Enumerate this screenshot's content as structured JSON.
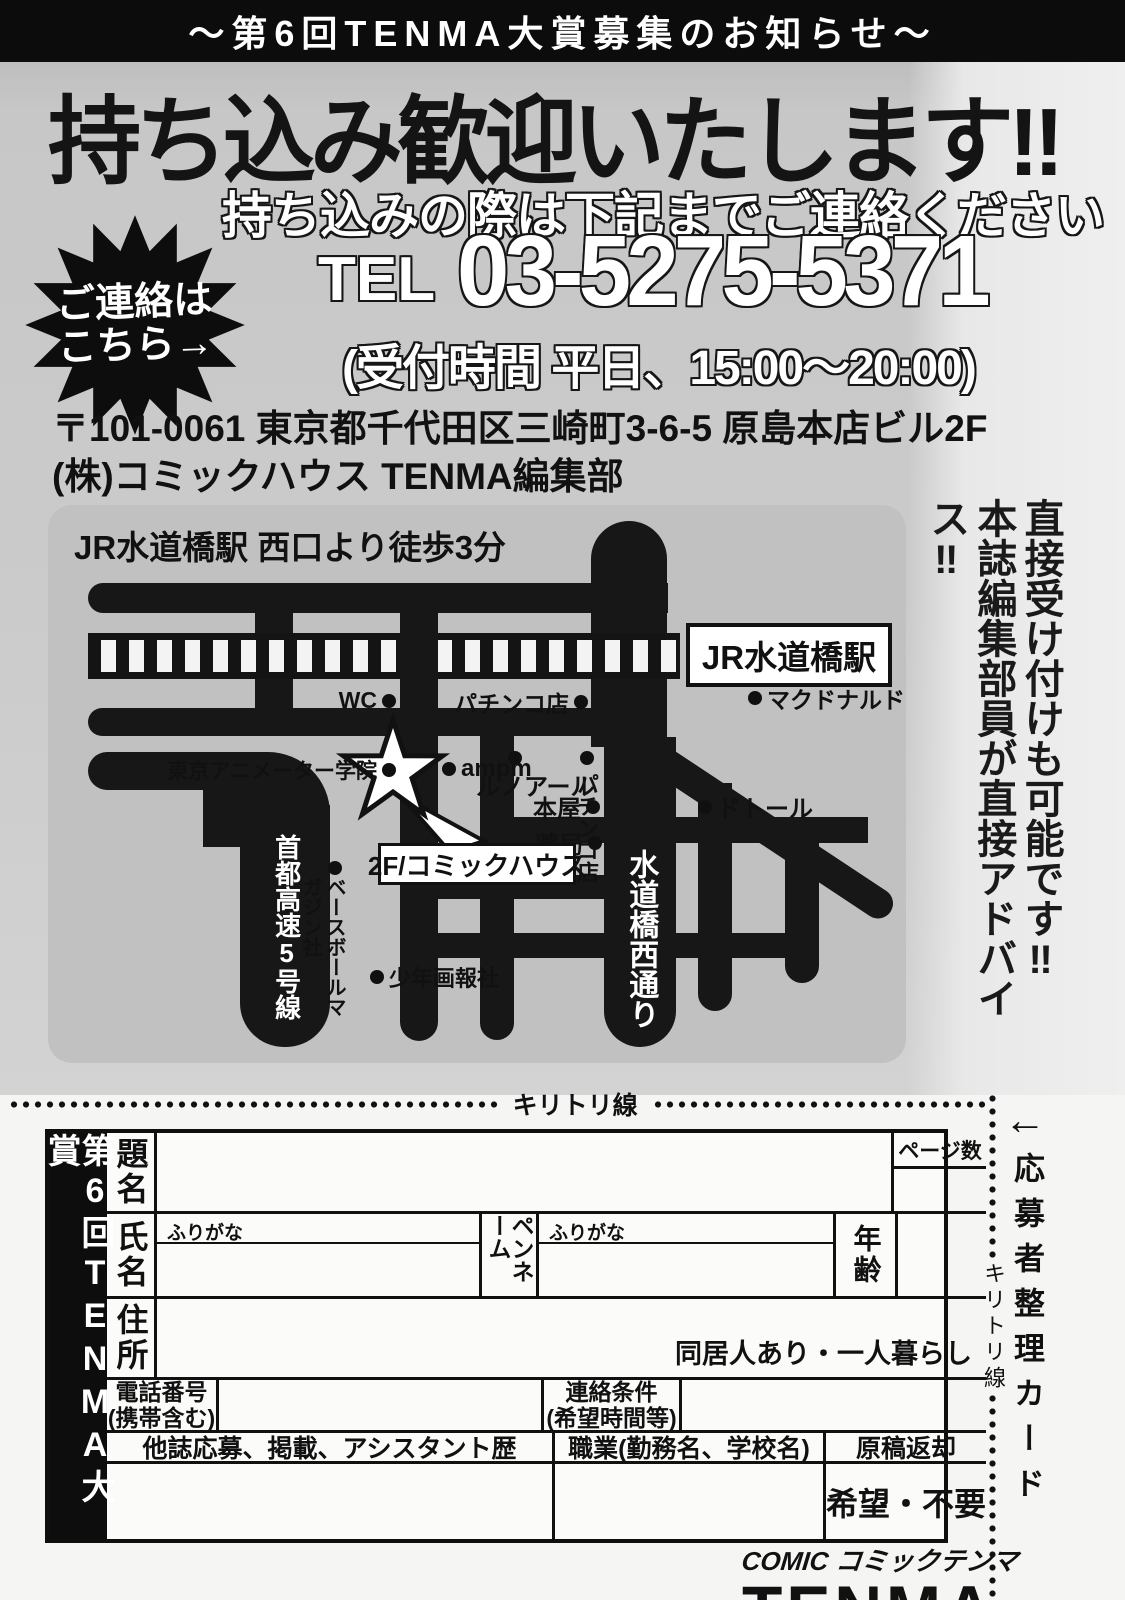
{
  "banner": {
    "title": "〜第6回TENMA大賞募集のお知らせ〜"
  },
  "hero": {
    "headline": "持ち込み歓迎いたします!!",
    "subheadline": "持ち込みの際は下記までご連絡ください",
    "burst": {
      "line1": "ご連絡は",
      "line2": "こちら→"
    },
    "tel_label": "TEL",
    "tel_number": "03-5275-5371",
    "tel_hours": "(受付時間 平日、15:00〜20:00)",
    "address1": "〒101-0061 東京都千代田区三崎町3-6-5 原島本店ビル2F",
    "address2": "(株)コミックハウス TENMA編集部"
  },
  "map": {
    "title": "JR水道橋駅  西口より徒歩3分",
    "station": "JR水道橋駅",
    "wc": "WC",
    "pachinko1": "パチンコ店",
    "mcdonalds": "マクドナルド",
    "animator_school": "東京アニメーター学院",
    "ampm": "ampm",
    "renoir": "ルノアール",
    "pachinko2": "パチンコ店",
    "bookstore": "本屋",
    "doutor": "ドトール",
    "pharmacy": "薬局",
    "office": "2F/コミックハウス",
    "baseball_magazine": "ベースボールマガジン社",
    "shonen_gahosha": "少年画報社",
    "expressway": "首都高速5号線",
    "street": "水道橋西通り"
  },
  "side_note": {
    "col1": "直接受け付けも可能です‼",
    "col2": "本誌編集部員が直接アドバイス‼"
  },
  "cut": {
    "label": "キリトリ線",
    "vertical_label": "キリトリ線",
    "arrow": "←",
    "card_label": "応募者整理カード"
  },
  "form": {
    "title": "第6回TENMA大賞",
    "title_label": "題名",
    "pages_label": "ページ数",
    "name_label": "氏名",
    "furigana_label": "ふりがな",
    "penname_label": "ペンネーム",
    "furigana2_label": "ふりがな",
    "age_label": "年齢",
    "address_label": "住所",
    "living_note": "同居人あり・一人暮らし",
    "phone_label1": "電話番号",
    "phone_label2": "(携帯含む)",
    "contact_label1": "連絡条件",
    "contact_label2": "(希望時間等)",
    "history_label": "他誌応募、掲載、アシスタント歴",
    "job_label": "職業(勤務名、学校名)",
    "return_label": "原稿返却",
    "return_options": "希望・不要"
  },
  "logo": {
    "top": "COMIC コミックテンマ",
    "main": "TENMA"
  }
}
